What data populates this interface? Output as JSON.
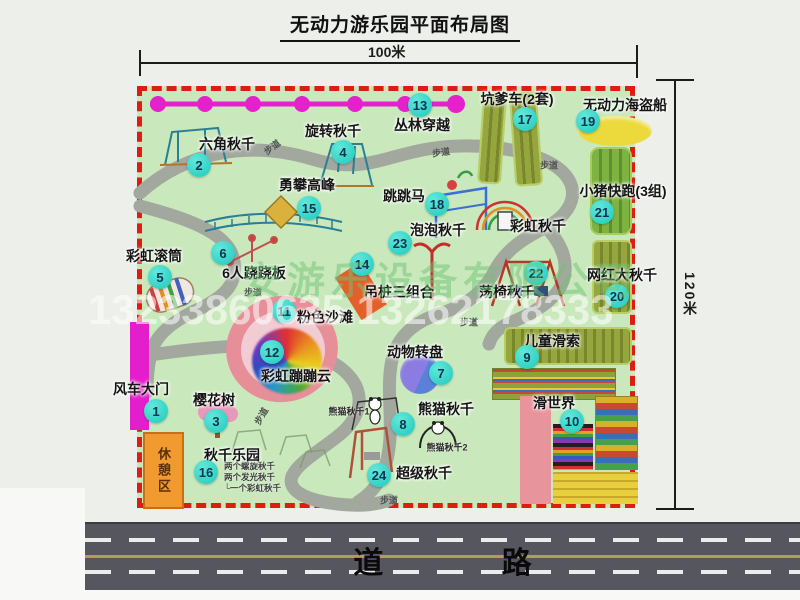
{
  "title": "无动力游乐园平面布局图",
  "scale": {
    "top": "100米",
    "right": "120米"
  },
  "road": {
    "label": "道 路"
  },
  "watermark": {
    "company": "安游乐设备有限公司",
    "phone": "13233860635 13262178333"
  },
  "rest_area_label": "休憩区",
  "trail_label": "步道",
  "swing_park_notes": [
    "两个螺旋秋千",
    "两个发光秋千",
    "一个彩虹秋千"
  ],
  "items": [
    {
      "n": "1",
      "label": "风车大门",
      "bx": 156,
      "by": 411,
      "lx": 141,
      "ly": 389
    },
    {
      "n": "2",
      "label": "六角秋千",
      "bx": 199,
      "by": 165,
      "lx": 227,
      "ly": 144
    },
    {
      "n": "3",
      "label": "樱花树",
      "bx": 216,
      "by": 421,
      "lx": 214,
      "ly": 400
    },
    {
      "n": "4",
      "label": "旋转秋千",
      "bx": 343,
      "by": 152,
      "lx": 333,
      "ly": 131
    },
    {
      "n": "5",
      "label": "彩虹滚筒",
      "bx": 160,
      "by": 277,
      "lx": 154,
      "ly": 256
    },
    {
      "n": "6",
      "label": "6人跷跷板",
      "bx": 223,
      "by": 253,
      "lx": 254,
      "ly": 273
    },
    {
      "n": "7",
      "label": "动物转盘",
      "bx": 441,
      "by": 373,
      "lx": 415,
      "ly": 352
    },
    {
      "n": "8",
      "label": "熊猫秋千",
      "bx": 403,
      "by": 424,
      "lx": 446,
      "ly": 409
    },
    {
      "n": "9",
      "label": "儿童滑索",
      "bx": 527,
      "by": 357,
      "lx": 552,
      "ly": 341
    },
    {
      "n": "10",
      "label": "滑世界",
      "bx": 572,
      "by": 421,
      "lx": 554,
      "ly": 403
    },
    {
      "n": "11",
      "label": "粉色沙滩",
      "bx": 284,
      "by": 311,
      "lx": 325,
      "ly": 317
    },
    {
      "n": "12",
      "label": "彩虹蹦蹦云",
      "bx": 272,
      "by": 352,
      "lx": 296,
      "ly": 376
    },
    {
      "n": "13",
      "label": "丛林穿越",
      "bx": 420,
      "by": 105,
      "lx": 422,
      "ly": 125
    },
    {
      "n": "14",
      "label": "吊桩三组合",
      "bx": 362,
      "by": 264,
      "lx": 399,
      "ly": 292
    },
    {
      "n": "15",
      "label": "勇攀高峰",
      "bx": 309,
      "by": 208,
      "lx": 307,
      "ly": 185
    },
    {
      "n": "16",
      "label": "秋千乐园",
      "bx": 206,
      "by": 472,
      "lx": 232,
      "ly": 455
    },
    {
      "n": "17",
      "label": "坑爹车(2套)",
      "bx": 525,
      "by": 119,
      "lx": 517,
      "ly": 99
    },
    {
      "n": "18",
      "label": "跳跳马",
      "bx": 437,
      "by": 204,
      "lx": 404,
      "ly": 196
    },
    {
      "n": "19",
      "label": "无动力海盗船",
      "bx": 588,
      "by": 121,
      "lx": 625,
      "ly": 105
    },
    {
      "n": "20",
      "label": "网红大秋千",
      "bx": 617,
      "by": 296,
      "lx": 622,
      "ly": 275
    },
    {
      "n": "21",
      "label": "小猪快跑(3组)",
      "bx": 602,
      "by": 212,
      "lx": 623,
      "ly": 191
    },
    {
      "n": "22",
      "label": "荡椅秋千",
      "bx": 536,
      "by": 273,
      "lx": 507,
      "ly": 292
    },
    {
      "n": "23",
      "label": "泡泡秋千",
      "bx": 400,
      "by": 243,
      "lx": 438,
      "ly": 230
    },
    {
      "n": "24",
      "label": "超级秋千",
      "bx": 379,
      "by": 475,
      "lx": 424,
      "ly": 473
    }
  ],
  "extra_labels": [
    {
      "text": "彩虹秋千",
      "x": 538,
      "y": 226,
      "small": false
    },
    {
      "text": "熊猫秋千1",
      "x": 349,
      "y": 411,
      "small": true
    },
    {
      "text": "熊猫秋千2",
      "x": 447,
      "y": 447,
      "small": true
    }
  ],
  "trail_positions": [
    {
      "x": 272,
      "y": 147,
      "rot": -38
    },
    {
      "x": 441,
      "y": 152,
      "rot": -8
    },
    {
      "x": 549,
      "y": 165,
      "rot": 0
    },
    {
      "x": 253,
      "y": 292,
      "rot": 0
    },
    {
      "x": 469,
      "y": 322,
      "rot": 0
    },
    {
      "x": 261,
      "y": 416,
      "rot": -60
    },
    {
      "x": 389,
      "y": 500,
      "rot": 0
    }
  ],
  "colors": {
    "map_green": "#c9e8bc",
    "border_red": "#dd1d12",
    "badge_teal": "#1fc9bd",
    "magenta": "#e41ecb",
    "road_gray": "#56565e",
    "panel_olive": "#95a63e",
    "rest_orange": "#f09a30"
  }
}
